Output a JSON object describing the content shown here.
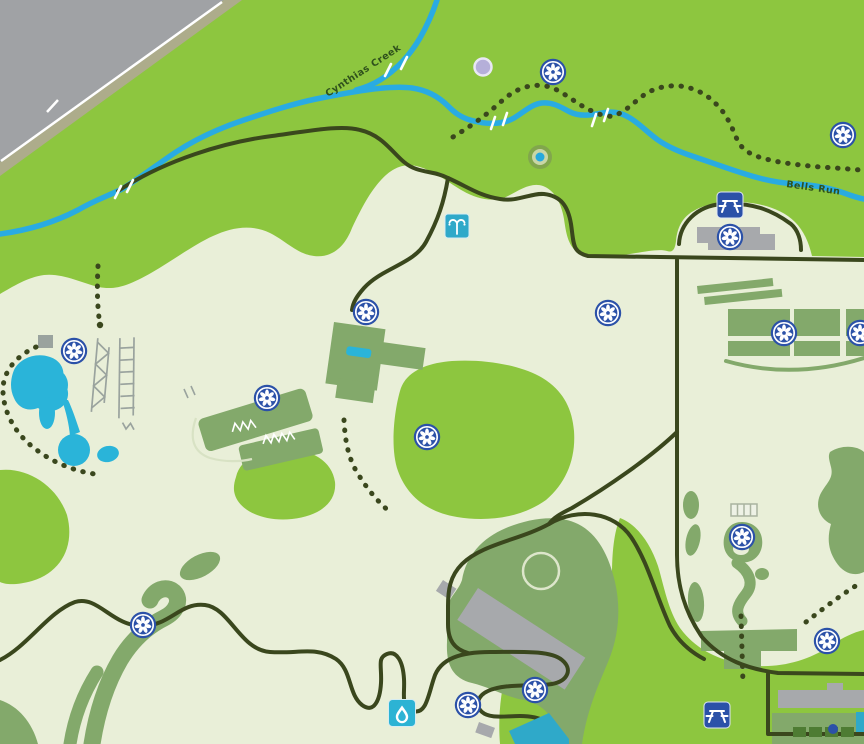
{
  "map": {
    "labels": {
      "creek": "Cynthias Creek",
      "run": "Bells Run"
    },
    "colors": {
      "field_green": "#8dc63f",
      "ground_pale": "#e9efd8",
      "garden_green": "#83a96b",
      "trail_dark": "#3a471d",
      "creek_blue": "#29abe2",
      "pond_blue": "#2ab4d9",
      "marker_blue": "#2b51a8",
      "icon_teal": "#2fa9c9",
      "building_gray": "#a7a9ac",
      "road_gray": "#a0a2a5"
    },
    "markers": {
      "flower": [
        [
          553,
          72
        ],
        [
          843,
          135
        ],
        [
          74,
          351
        ],
        [
          366,
          312
        ],
        [
          267,
          398
        ],
        [
          427,
          437
        ],
        [
          608,
          313
        ],
        [
          730,
          237
        ],
        [
          784,
          333
        ],
        [
          860,
          333
        ],
        [
          742,
          537
        ],
        [
          143,
          625
        ],
        [
          535,
          690
        ],
        [
          468,
          705
        ],
        [
          827,
          641
        ]
      ],
      "picnic": [
        [
          730,
          205
        ],
        [
          717,
          715
        ]
      ],
      "fountain": [
        [
          457,
          226
        ]
      ],
      "water": [
        [
          402,
          713
        ]
      ],
      "spring": [
        [
          540,
          157
        ]
      ],
      "unknown": [
        [
          483,
          67
        ]
      ]
    }
  }
}
